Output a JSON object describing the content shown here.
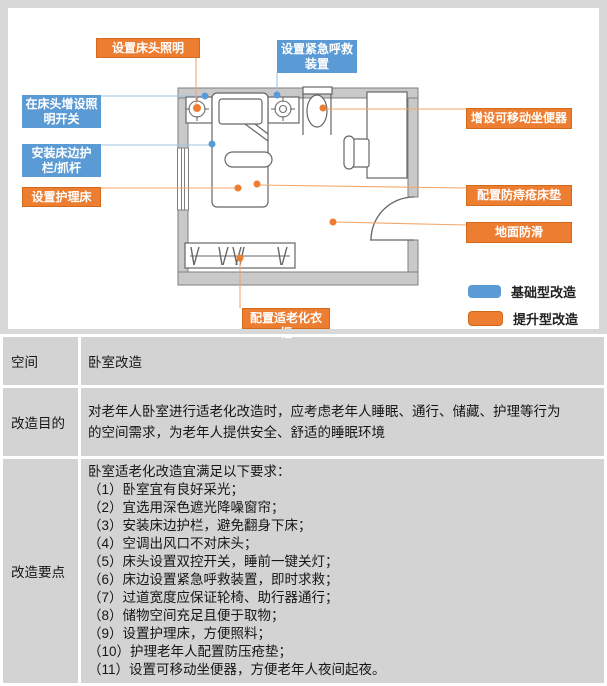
{
  "diagram": {
    "title_hint": "bedroom accessibility renovation floor plan",
    "callouts": [
      {
        "id": "bedside-lighting",
        "text": "设置床头照明",
        "type": "upgrade"
      },
      {
        "id": "emergency-call",
        "text": "设置紧急呼救装置",
        "type": "basic"
      },
      {
        "id": "bedhead-light-switch",
        "text": "在床头增设照明开关",
        "type": "basic"
      },
      {
        "id": "bed-rail-grab-bar",
        "text": "安装床边护栏/抓杆",
        "type": "basic"
      },
      {
        "id": "nursing-bed",
        "text": "设置护理床",
        "type": "upgrade"
      },
      {
        "id": "movable-toilet",
        "text": "增设可移动坐便器",
        "type": "upgrade"
      },
      {
        "id": "anti-bedsore-mattress",
        "text": "配置防痔疮床垫",
        "type": "upgrade"
      },
      {
        "id": "anti-slip-floor",
        "text": "地面防滑",
        "type": "upgrade"
      },
      {
        "id": "elderly-wardrobe",
        "text": "配置适老化衣柜",
        "type": "upgrade"
      }
    ],
    "legend": [
      {
        "label": "基础型改造",
        "color": "#5B9BD5"
      },
      {
        "label": "提升型改造",
        "color": "#ED7D31"
      }
    ],
    "colors": {
      "basic": "#5B9BD5",
      "upgrade": "#ED7D31",
      "wall": "#C9C9C9",
      "line": "#666666"
    },
    "floor_plan_symbols": [
      "bed",
      "pillow",
      "nightstand",
      "bedside-lamp",
      "window",
      "toilet",
      "desk",
      "chair",
      "door",
      "wardrobe-with-hangers"
    ]
  },
  "table": {
    "rows": [
      {
        "header": "空间",
        "content": "卧室改造"
      },
      {
        "header": "改造目的",
        "content": "对老年人卧室进行适老化改造时，应考虑老年人睡眠、通行、储藏、护理等行为\n的空间需求，为老年人提供安全、舒适的睡眠环境"
      },
      {
        "header": "改造要点",
        "content": "卧室适老化改造宜满足以下要求：\n（1）卧室宜有良好采光；\n（2）宜选用深色遮光降噪窗帘；\n（3）安装床边护栏，避免翻身下床；\n（4）空调出风口不对床头；\n（5）床头设置双控开关，睡前一键关灯；\n（6）床边设置紧急呼救装置，即时求救；\n（7）过道宽度应保证轮椅、助行器通行；\n（8）储物空间充足且便于取物；\n（9）设置护理床，方便照料；\n（10）护理老年人配置防压疮垫；\n（11）设置可移动坐便器，方便老年人夜间起夜。"
      }
    ]
  }
}
